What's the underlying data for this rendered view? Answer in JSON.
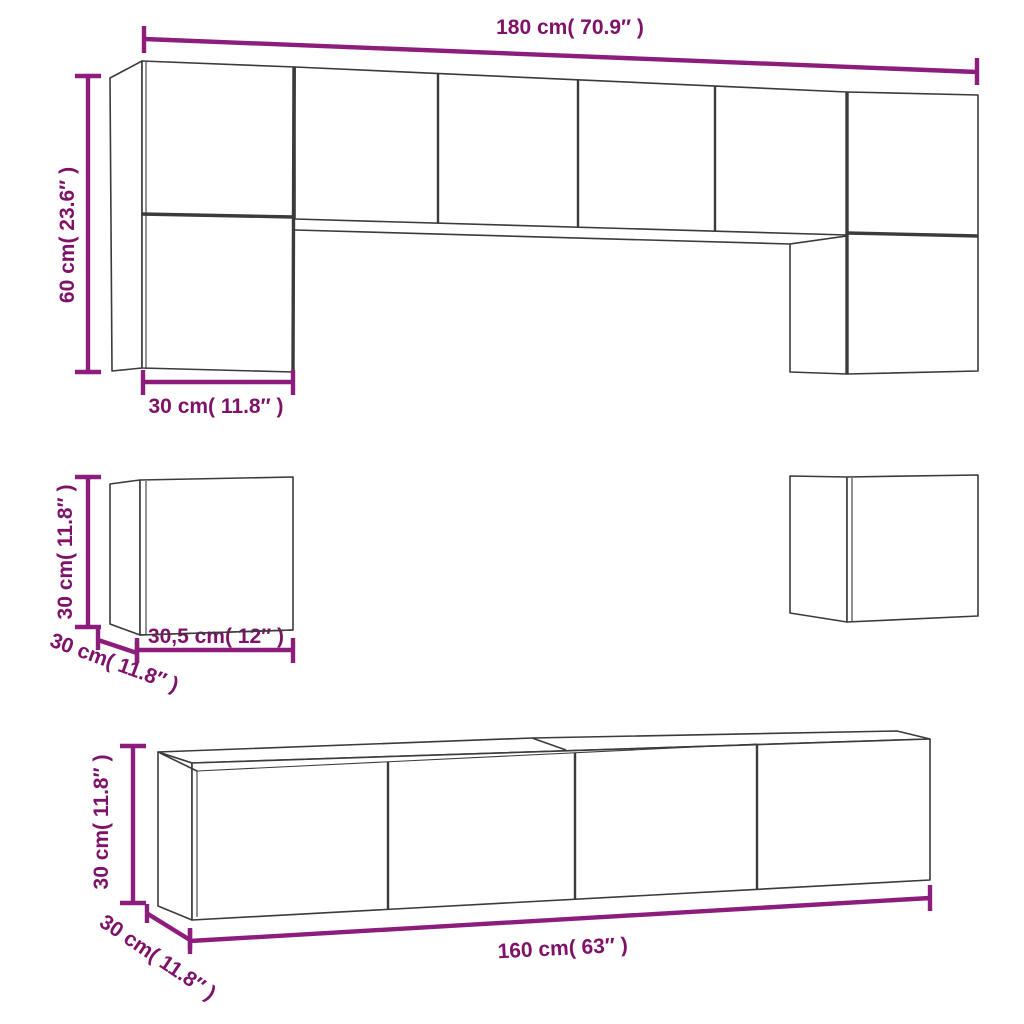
{
  "diagram": {
    "title": "tv-cabinet-set-dimension-diagram",
    "colors": {
      "dimension_line": "#8C1D7C",
      "dimension_text": "#7E1168",
      "edge": "#3B3B3B",
      "background": "#FFFFFF"
    },
    "dimensions": {
      "top_width": {
        "label": "180 cm( 70.9″ )"
      },
      "top_height": {
        "label": "60 cm( 23.6″ )"
      },
      "top_depth": {
        "label": "30 cm( 11.8″ )"
      },
      "mid_height": {
        "label": "30 cm( 11.8″ )"
      },
      "mid_width": {
        "label": "30,5 cm( 12″ )"
      },
      "mid_depth": {
        "label": "30 cm( 11.8″ )"
      },
      "bottom_height": {
        "label": "30 cm( 11.8″ )"
      },
      "bottom_width": {
        "label": "160 cm( 63″ )"
      },
      "bottom_depth": {
        "label": "30 cm( 11.8″ )"
      }
    }
  }
}
